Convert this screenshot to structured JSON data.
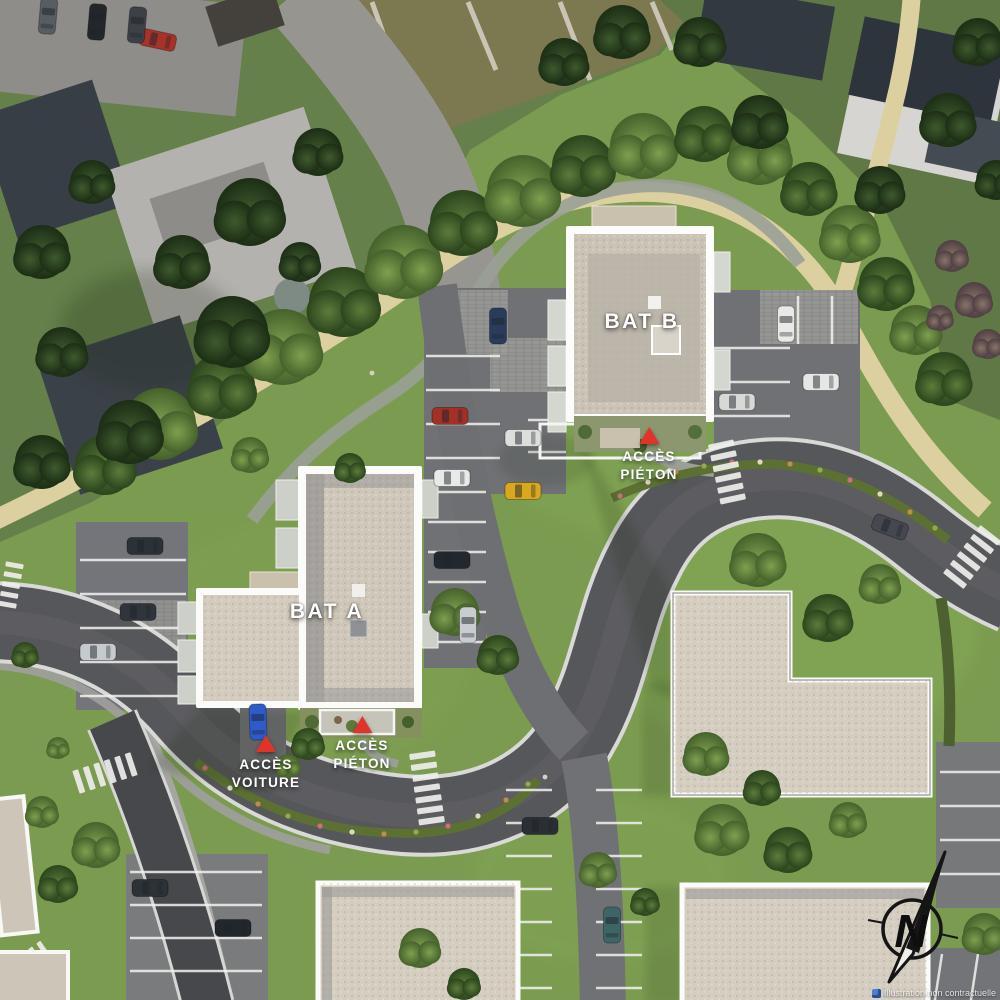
{
  "title_labels": {
    "bat_a": "BAT A",
    "bat_b": "BAT B"
  },
  "markers": {
    "acces_pieton_bat_b": {
      "line1": "ACCÈS",
      "line2": "PIÉTON"
    },
    "acces_pieton_bat_a": {
      "line1": "ACCÈS",
      "line2": "PIÉTON"
    },
    "acces_voiture": {
      "line1": "ACCÈS",
      "line2": "VOITURE"
    }
  },
  "compass": {
    "letter": "N"
  },
  "footer": {
    "disclaimer": "Illustration non contractuelle"
  },
  "colors": {
    "marker_red": "#e0342b",
    "label_text": "#ffffff",
    "roof_light": "#d2cbbe",
    "asphalt": "#56575a",
    "grass_render": "#7b9b50",
    "grass_photo": "#65804a",
    "path_tan": "#ddd0a0",
    "path_gray": "#9aa096"
  }
}
